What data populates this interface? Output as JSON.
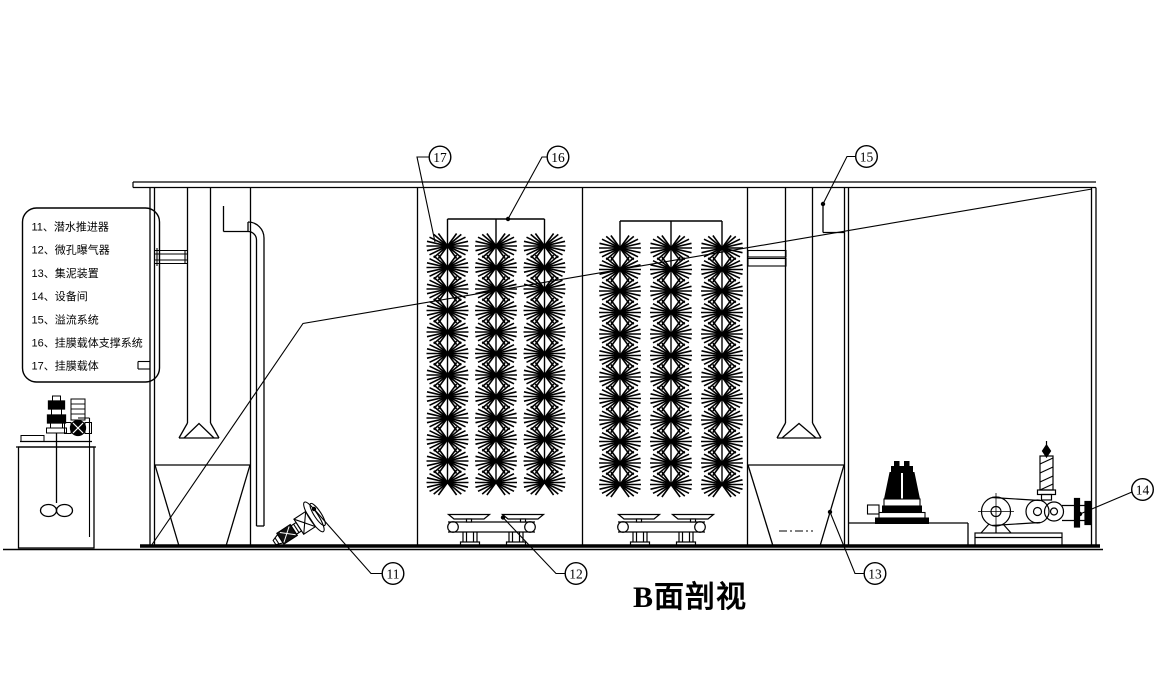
{
  "title": "B面剖视",
  "legend": {
    "items": [
      "11、潜水推进器",
      "12、微孔曝气器",
      "13、集泥装置",
      "14、设备间",
      "15、溢流系统",
      "16、挂膜载体支撑系统",
      "17、挂膜载体"
    ]
  },
  "callouts": [
    {
      "label": "17",
      "cx": 440,
      "cy": 157,
      "leader": "429,157 417,157 435,242",
      "dot": null
    },
    {
      "label": "16",
      "cx": 558,
      "cy": 157,
      "leader": "547,157 542,157 508,219",
      "dot": [
        508,
        219
      ]
    },
    {
      "label": "15",
      "cx": 866.5,
      "cy": 156.5,
      "leader": "855.5,156.5 847,156.5 823,204",
      "dot": [
        823,
        204
      ]
    },
    {
      "label": "11",
      "cx": 393,
      "cy": 573.5,
      "leader": "382,573.5 371,573.5 314,509",
      "dot": [
        314,
        509
      ]
    },
    {
      "label": "12",
      "cx": 576,
      "cy": 573.5,
      "leader": "565,573.5 556,573.5 503,517.5",
      "dot": [
        503,
        517.5
      ]
    },
    {
      "label": "13",
      "cx": 875,
      "cy": 573.5,
      "leader": "864,573.5 855,573.5 830,512",
      "dot": [
        830,
        512
      ]
    },
    {
      "label": "14",
      "cx": 1142.5,
      "cy": 489.5,
      "leader": "1132,492 1080,514",
      "dot": [
        1080,
        514
      ]
    }
  ],
  "colors": {
    "ink": "#000000",
    "paper": "#ffffff"
  }
}
